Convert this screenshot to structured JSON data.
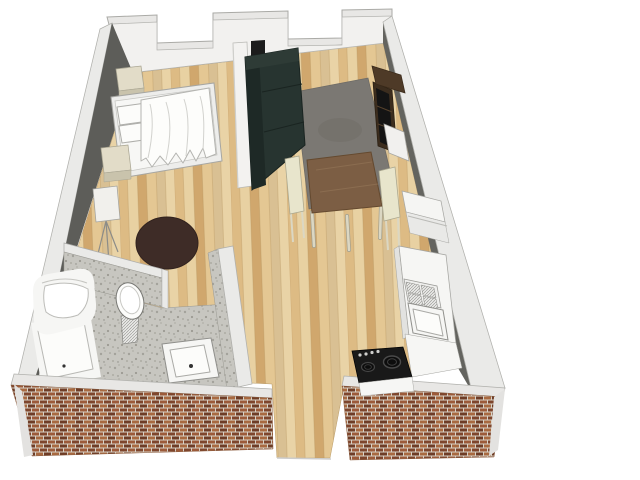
{
  "scene": {
    "type": "3d-floor-plan",
    "view": "isometric-overhead",
    "description": "3D cutaway floor plan of a studio apartment with crenellated back wall and brick front walls",
    "rooms": [
      {
        "name": "bedroom",
        "furniture": [
          "double-bed",
          "pillows",
          "duvet",
          "nightstand",
          "nightstand",
          "tripod-floor-lamp",
          "round-rug"
        ]
      },
      {
        "name": "living-dining-area",
        "furniture": [
          "dark-sofa",
          "gray-area-rug",
          "square-dining-table",
          "dining-chair",
          "dining-chair",
          "bookshelf",
          "white-cabinet"
        ]
      },
      {
        "name": "kitchen",
        "furniture": [
          "refrigerator",
          "counter",
          "drainboard-sink",
          "basin",
          "corner-counter",
          "black-cooktop"
        ]
      },
      {
        "name": "bathroom",
        "furniture": [
          "bathtub",
          "corner-shower",
          "toilet",
          "square-washbasin"
        ]
      }
    ],
    "openings": [
      "front-entrance-gap",
      "bathroom-door-gap",
      "back-wall-window-notch",
      "back-wall-window-notch"
    ]
  },
  "colors": {
    "background": "#ffffff",
    "wood_plank_1": "#ddbb84",
    "wood_plank_2": "#e8d1a2",
    "wood_plank_3": "#d0a76d",
    "wood_plank_4": "#e4c793",
    "wood_plank_5": "#d9c093",
    "wood_plank_6": "#e9d3a6",
    "tile_base": "#c7c6c0",
    "tile_speckle": "#9b9a92",
    "brick_mortar": "#d8d2c7",
    "brick_1": "#9c5a39",
    "brick_2": "#7e452c",
    "brick_3": "#a86940",
    "brick_4": "#6e3c26",
    "wall_face_white": "#f2f1ef",
    "wall_top_white": "#e8e7e5",
    "wall_band_white": "#eaeae8",
    "wall_gray_left": "#5d5d59",
    "wall_gray_right": "#64645f",
    "partition_white": "#f3f2f0",
    "frame_white": "#ededeb",
    "bed_white": "#f7f7f5",
    "duvet_white": "#fdfdfb",
    "nightstand_top": "#e2dcc8",
    "nightstand_front": "#c9c3ac",
    "lamp_shade": "#f1f0ec",
    "rug_round": "#3e2c27",
    "rug_gray": "#7b7873",
    "sofa_dark": "#273430",
    "sofa_shadow": "#1e2926",
    "sofa_light": "#2e3b36",
    "table_brown": "#7c5e44",
    "chair_cream": "#e8e5cc",
    "leg_cream": "#dbd7c3",
    "shelf_brown": "#4e3a27",
    "shelf_face": "#3c2d1e",
    "shelf_slot": "#141414",
    "cabinet_white": "#f1f0ee",
    "fridge_white": "#f5f5f3",
    "fridge_front": "#e9e9e7",
    "counter_white": "#f6f6f4",
    "counter_side": "#e2e2e0",
    "fixture_white": "#f6f6f4",
    "fixture_bright": "#fcfcfa",
    "cooktop_black": "#191919",
    "knob_light": "#cfcfcd",
    "drain_dark": "#333333"
  }
}
